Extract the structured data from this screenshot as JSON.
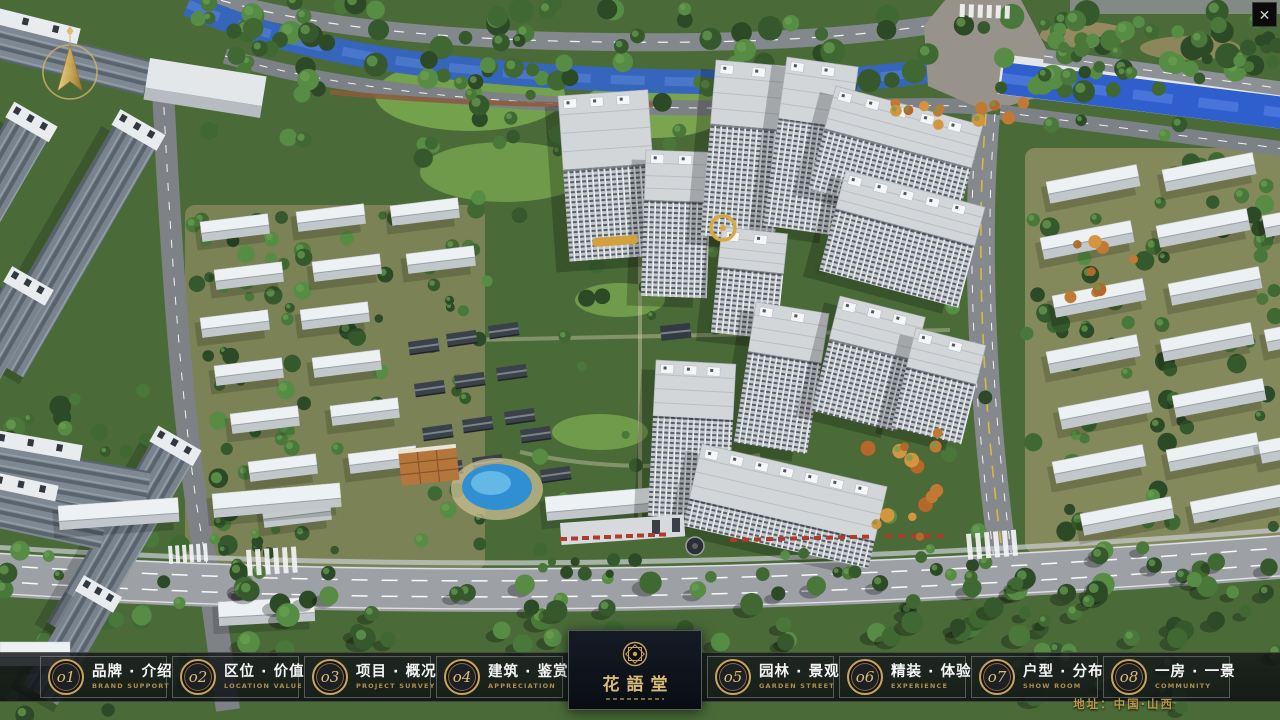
{
  "window": {
    "close_glyph": "✕"
  },
  "nav": {
    "items": [
      {
        "num": "o1",
        "zh": "品牌 · 介绍",
        "en": "BRAND SUPPORT"
      },
      {
        "num": "o2",
        "zh": "区位 · 价值",
        "en": "LOCATION VALUE"
      },
      {
        "num": "o3",
        "zh": "项目 · 概况",
        "en": "PROJECT SURVEY"
      },
      {
        "num": "o4",
        "zh": "建筑 · 鉴赏",
        "en": "APPRECIATION"
      },
      {
        "num": "o5",
        "zh": "园林 · 景观",
        "en": "GARDEN STREET"
      },
      {
        "num": "o6",
        "zh": "精装 · 体验",
        "en": "EXPERIENCE"
      },
      {
        "num": "o7",
        "zh": "户型 · 分布",
        "en": "SHOW ROOM"
      },
      {
        "num": "o8",
        "zh": "一房 · 一景",
        "en": "COMMUNITY"
      }
    ]
  },
  "logo": {
    "title": "花語堂"
  },
  "footer": {
    "address": "地址：中国·山西"
  },
  "colors": {
    "gold": "#c9a55c",
    "bar_bg": "rgba(10,13,16,0.80)",
    "river": "#2f5ecd"
  }
}
